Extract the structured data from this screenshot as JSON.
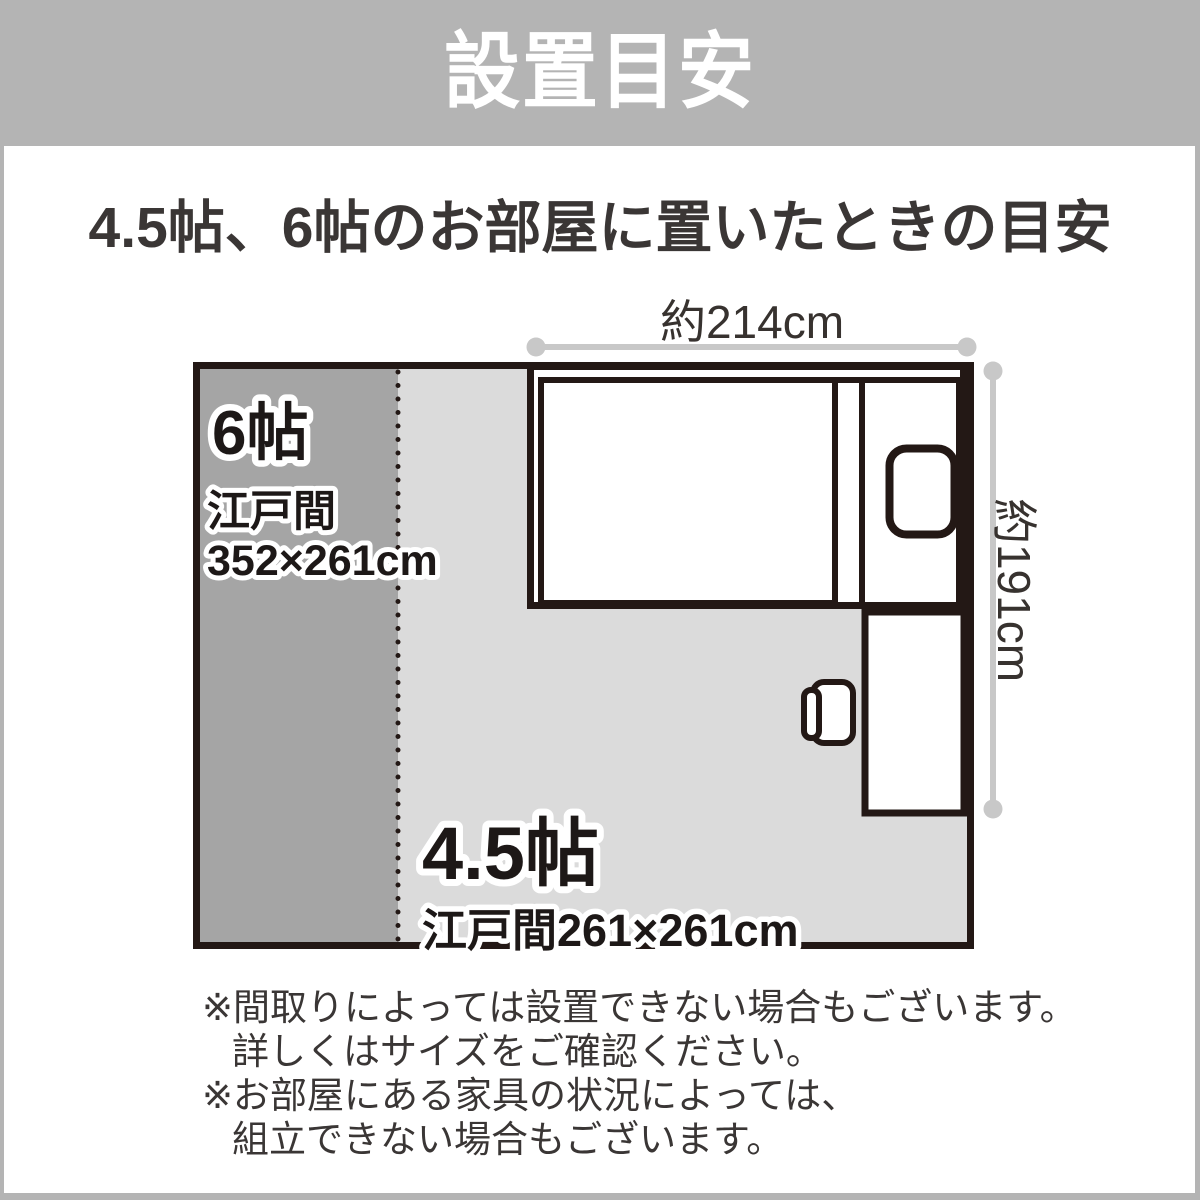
{
  "header": {
    "title": "設置目安"
  },
  "page": {
    "subtitle": "4.5帖、6帖のお部屋に置いたときの目安"
  },
  "diagram": {
    "room_6jo": {
      "size": "6帖",
      "layout": "江戸間",
      "dimensions": "352×261cm"
    },
    "room_45jo": {
      "size": "4.5帖",
      "dimensions": "江戸間261×261cm"
    },
    "bed": {
      "width": "約214cm",
      "depth": "約191cm"
    }
  },
  "footnotes": {
    "lines": [
      "※間取りによっては設置できない場合もございます。",
      "詳しくはサイズをご確認ください。",
      "※お部屋にある家具の状況によっては、",
      "組立できない場合もございます。"
    ]
  },
  "colors": {
    "frame_gray": "#b4b4b4",
    "room_dark_gray": "#a5a5a5",
    "room_light_gray": "#dbdbdb",
    "ink": "#231815",
    "label_ink": "#1d1817",
    "text_dark": "#3a3635",
    "measure_gray": "#c8c8c8"
  }
}
